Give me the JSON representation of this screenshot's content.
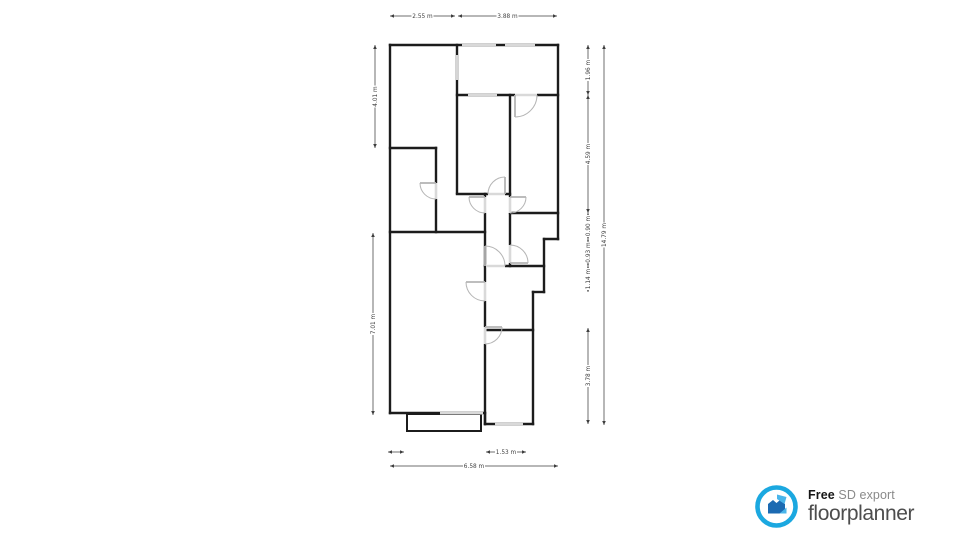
{
  "page": {
    "background": "#ffffff"
  },
  "logo": {
    "free_label": "Free",
    "export_label": "SD export",
    "brand": "floorplanner",
    "ring_color": "#1ba8e0",
    "house_dark": "#1b6ab2",
    "house_light": "#4ab5ea",
    "text_dark": "#161616",
    "text_gray": "#8a8a8a",
    "brand_color": "#4d4d4d"
  },
  "plan": {
    "wall_color": "#1c1c1c",
    "wall_width": 2.4,
    "window_band_color": "#b3b3b3",
    "window_core_color": "#ffffff",
    "opening_color": "#d9d9d9",
    "door_color": "#b5b5b5",
    "dim_color": "#3f3f3f",
    "walls": [
      [
        390,
        45,
        558,
        45
      ],
      [
        558,
        45,
        558,
        239
      ],
      [
        558,
        239,
        544,
        239
      ],
      [
        544,
        239,
        544,
        292
      ],
      [
        544,
        292,
        533,
        292
      ],
      [
        533,
        292,
        533,
        424
      ],
      [
        533,
        424,
        485,
        424
      ],
      [
        485,
        424,
        485,
        413
      ],
      [
        485,
        413,
        390,
        413
      ],
      [
        390,
        413,
        390,
        45
      ],
      [
        457,
        45,
        457,
        193
      ],
      [
        457,
        95,
        558,
        95
      ],
      [
        510,
        95,
        510,
        266
      ],
      [
        510,
        213,
        558,
        213
      ],
      [
        457,
        194,
        510,
        194
      ],
      [
        485,
        194,
        485,
        424
      ],
      [
        485,
        266,
        544,
        266
      ],
      [
        485,
        330,
        533,
        330
      ],
      [
        390,
        148,
        436,
        148
      ],
      [
        436,
        148,
        436,
        232
      ],
      [
        390,
        232,
        485,
        232
      ]
    ],
    "bay": {
      "x": 407,
      "y": 414,
      "w": 74,
      "h": 17
    },
    "windows": [
      [
        457,
        55,
        457,
        80
      ],
      [
        468,
        95,
        497,
        95
      ],
      [
        462,
        45,
        496,
        45
      ],
      [
        505,
        45,
        535,
        45
      ],
      [
        440,
        413,
        483,
        413
      ],
      [
        495,
        424,
        523,
        424
      ]
    ],
    "openings": [
      [
        515,
        95,
        537,
        95
      ],
      [
        510,
        197,
        510,
        213
      ],
      [
        485,
        197,
        485,
        213
      ],
      [
        488,
        194,
        505,
        194
      ],
      [
        510,
        245,
        510,
        263
      ],
      [
        486,
        266,
        505,
        266
      ],
      [
        436,
        183,
        436,
        199
      ],
      [
        485,
        282,
        485,
        301
      ],
      [
        485,
        327,
        485,
        344
      ]
    ],
    "doors": [
      {
        "leaf": [
          515,
          95,
          515,
          117
        ],
        "arc": "M515,117 A22,22 0 0 0 537,95"
      },
      {
        "leaf": [
          510,
          197,
          526,
          197
        ],
        "arc": "M526,197 A16,16 0 0 1 510,213"
      },
      {
        "leaf": [
          485,
          197,
          469,
          197
        ],
        "arc": "M469,197 A16,16 0 0 0 485,213"
      },
      {
        "leaf": [
          505,
          194,
          505,
          177
        ],
        "arc": "M505,177 A17,17 0 0 0 488,194"
      },
      {
        "leaf": [
          510,
          263,
          528,
          263
        ],
        "arc": "M528,263 A18,18 0 0 0 510,245"
      },
      {
        "leaf": [
          485,
          266,
          485,
          246
        ],
        "arc": "M485,246 A20,20 0 0 1 505,266"
      },
      {
        "leaf": [
          436,
          183,
          420,
          183
        ],
        "arc": "M420,183 A16,16 0 0 0 436,199"
      },
      {
        "leaf": [
          485,
          282,
          466,
          282
        ],
        "arc": "M466,282 A19,19 0 0 0 485,301"
      },
      {
        "leaf": [
          485,
          327,
          502,
          327
        ],
        "arc": "M502,327 A17,17 0 0 1 485,344"
      }
    ],
    "dimensions": [
      {
        "x1": 390,
        "y1": 16,
        "x2": 455,
        "y2": 16,
        "label": "2.55 m"
      },
      {
        "x1": 458,
        "y1": 16,
        "x2": 557,
        "y2": 16,
        "label": "3.88 m"
      },
      {
        "x1": 375,
        "y1": 45,
        "x2": 375,
        "y2": 148,
        "label": "4.01 m"
      },
      {
        "x1": 373,
        "y1": 233,
        "x2": 373,
        "y2": 415,
        "label": "7.01 m"
      },
      {
        "x1": 588,
        "y1": 45,
        "x2": 588,
        "y2": 95,
        "label": "1.96 m"
      },
      {
        "x1": 588,
        "y1": 95,
        "x2": 588,
        "y2": 213,
        "label": "4.59 m"
      },
      {
        "x1": 588,
        "y1": 213,
        "x2": 588,
        "y2": 239,
        "label": "0.90 m"
      },
      {
        "x1": 588,
        "y1": 239,
        "x2": 588,
        "y2": 266,
        "label": "0.93 m"
      },
      {
        "x1": 588,
        "y1": 266,
        "x2": 588,
        "y2": 292,
        "label": "1.14 m"
      },
      {
        "x1": 588,
        "y1": 328,
        "x2": 588,
        "y2": 424,
        "label": "3.78 m"
      },
      {
        "x1": 604,
        "y1": 45,
        "x2": 604,
        "y2": 425,
        "label": "14.79 m"
      },
      {
        "x1": 388,
        "y1": 452,
        "x2": 404,
        "y2": 452,
        "label": ""
      },
      {
        "x1": 486,
        "y1": 452,
        "x2": 526,
        "y2": 452,
        "label": "1.53 m"
      },
      {
        "x1": 390,
        "y1": 466,
        "x2": 558,
        "y2": 466,
        "label": "6.58 m"
      }
    ]
  }
}
